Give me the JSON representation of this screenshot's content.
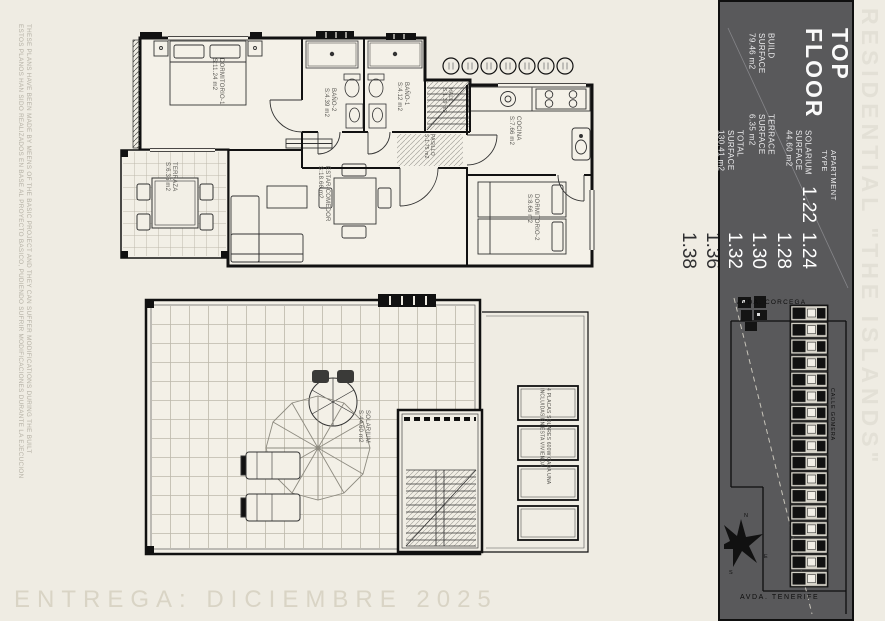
{
  "sheet": {
    "background": "#efece3",
    "panel_color": "#59595b",
    "ink": "#111111",
    "delivery_text": "ENTREGA: DICIEMBRE 2025",
    "brand_vertical": "RESIDENTIAL \"THE ISLANDS\"",
    "disclaimer_en": "THESE PLANS HAVE BEEN MADE BY MEENS OF THE BASIC PROJECT AND THEY CAN SUFFER MODIFICATIONS DURING THE BUILT",
    "disclaimer_es": "ESTOS PLANOS HAN SIDO REALIZADOS EN BASE AL PROYECTO BASICO, PUDIENDO SUFRIR MODIFICACIONES DURANTE LA EJECUCION"
  },
  "title_block": {
    "floor_line1": "TOP",
    "floor_line2": "FLOOR",
    "apartment_label_line1": "APARTMENT",
    "apartment_label_line2": "TYPE",
    "apartments_on_panel": [
      "1.22",
      "1.24",
      "1.28",
      "1.30",
      "1.32"
    ],
    "apartments_off_panel": [
      "1.36",
      "1.38"
    ],
    "build": {
      "l1": "BUILD",
      "l2": "SURFACE",
      "value": "79.46 m2"
    },
    "solarium": {
      "l1": "SOLARIUM",
      "l2": "SURFACE",
      "value": "44.60 m2"
    },
    "terrace": {
      "l1": "TERRACE",
      "l2": "SURFACE",
      "value": "6.35 m2"
    },
    "total": {
      "l1": "TOTAL",
      "l2": "SURFACE",
      "value": "130.41 m2"
    }
  },
  "rooms": {
    "dormitorio1": {
      "name": "DORMITORIO-1",
      "area": "S:11.24 m2"
    },
    "bano2": {
      "name": "BAÑO-2",
      "area": "S:4.39 m2"
    },
    "bano1": {
      "name": "BAÑO-1",
      "area": "S:4.12 m2"
    },
    "pasillo": {
      "name": "PASILLO",
      "area": "S:1.75 m2"
    },
    "hall": {
      "name": "HALL",
      "area": "S:1.39 m2"
    },
    "cocina": {
      "name": "COCINA",
      "area": "S:7.66 m2"
    },
    "dormitorio2": {
      "name": "DORMITORIO-2",
      "area": "S:8.66 m2"
    },
    "estar": {
      "name": "ESTAR-COMEDOR",
      "area": "S:18.66 m2"
    },
    "terraza": {
      "name": "TERRAZA",
      "area": "S:6.35 m2"
    },
    "solarium": {
      "name": "SOLARIUM",
      "area": "S:44.60 m2"
    }
  },
  "solar_note": {
    "line1": "4 PLACAS SOLARES 600W CADA UNA",
    "line2": "INCLUIDAS EN ESTA VIVIENDA"
  },
  "site_map": {
    "street_top": "AVDA. CORCEGA",
    "street_right": "CALLE GOMERA",
    "street_bottom": "AVDA. TENERIFE"
  },
  "compass": {
    "n": "N",
    "e": "E",
    "s": "S",
    "w": "W"
  }
}
